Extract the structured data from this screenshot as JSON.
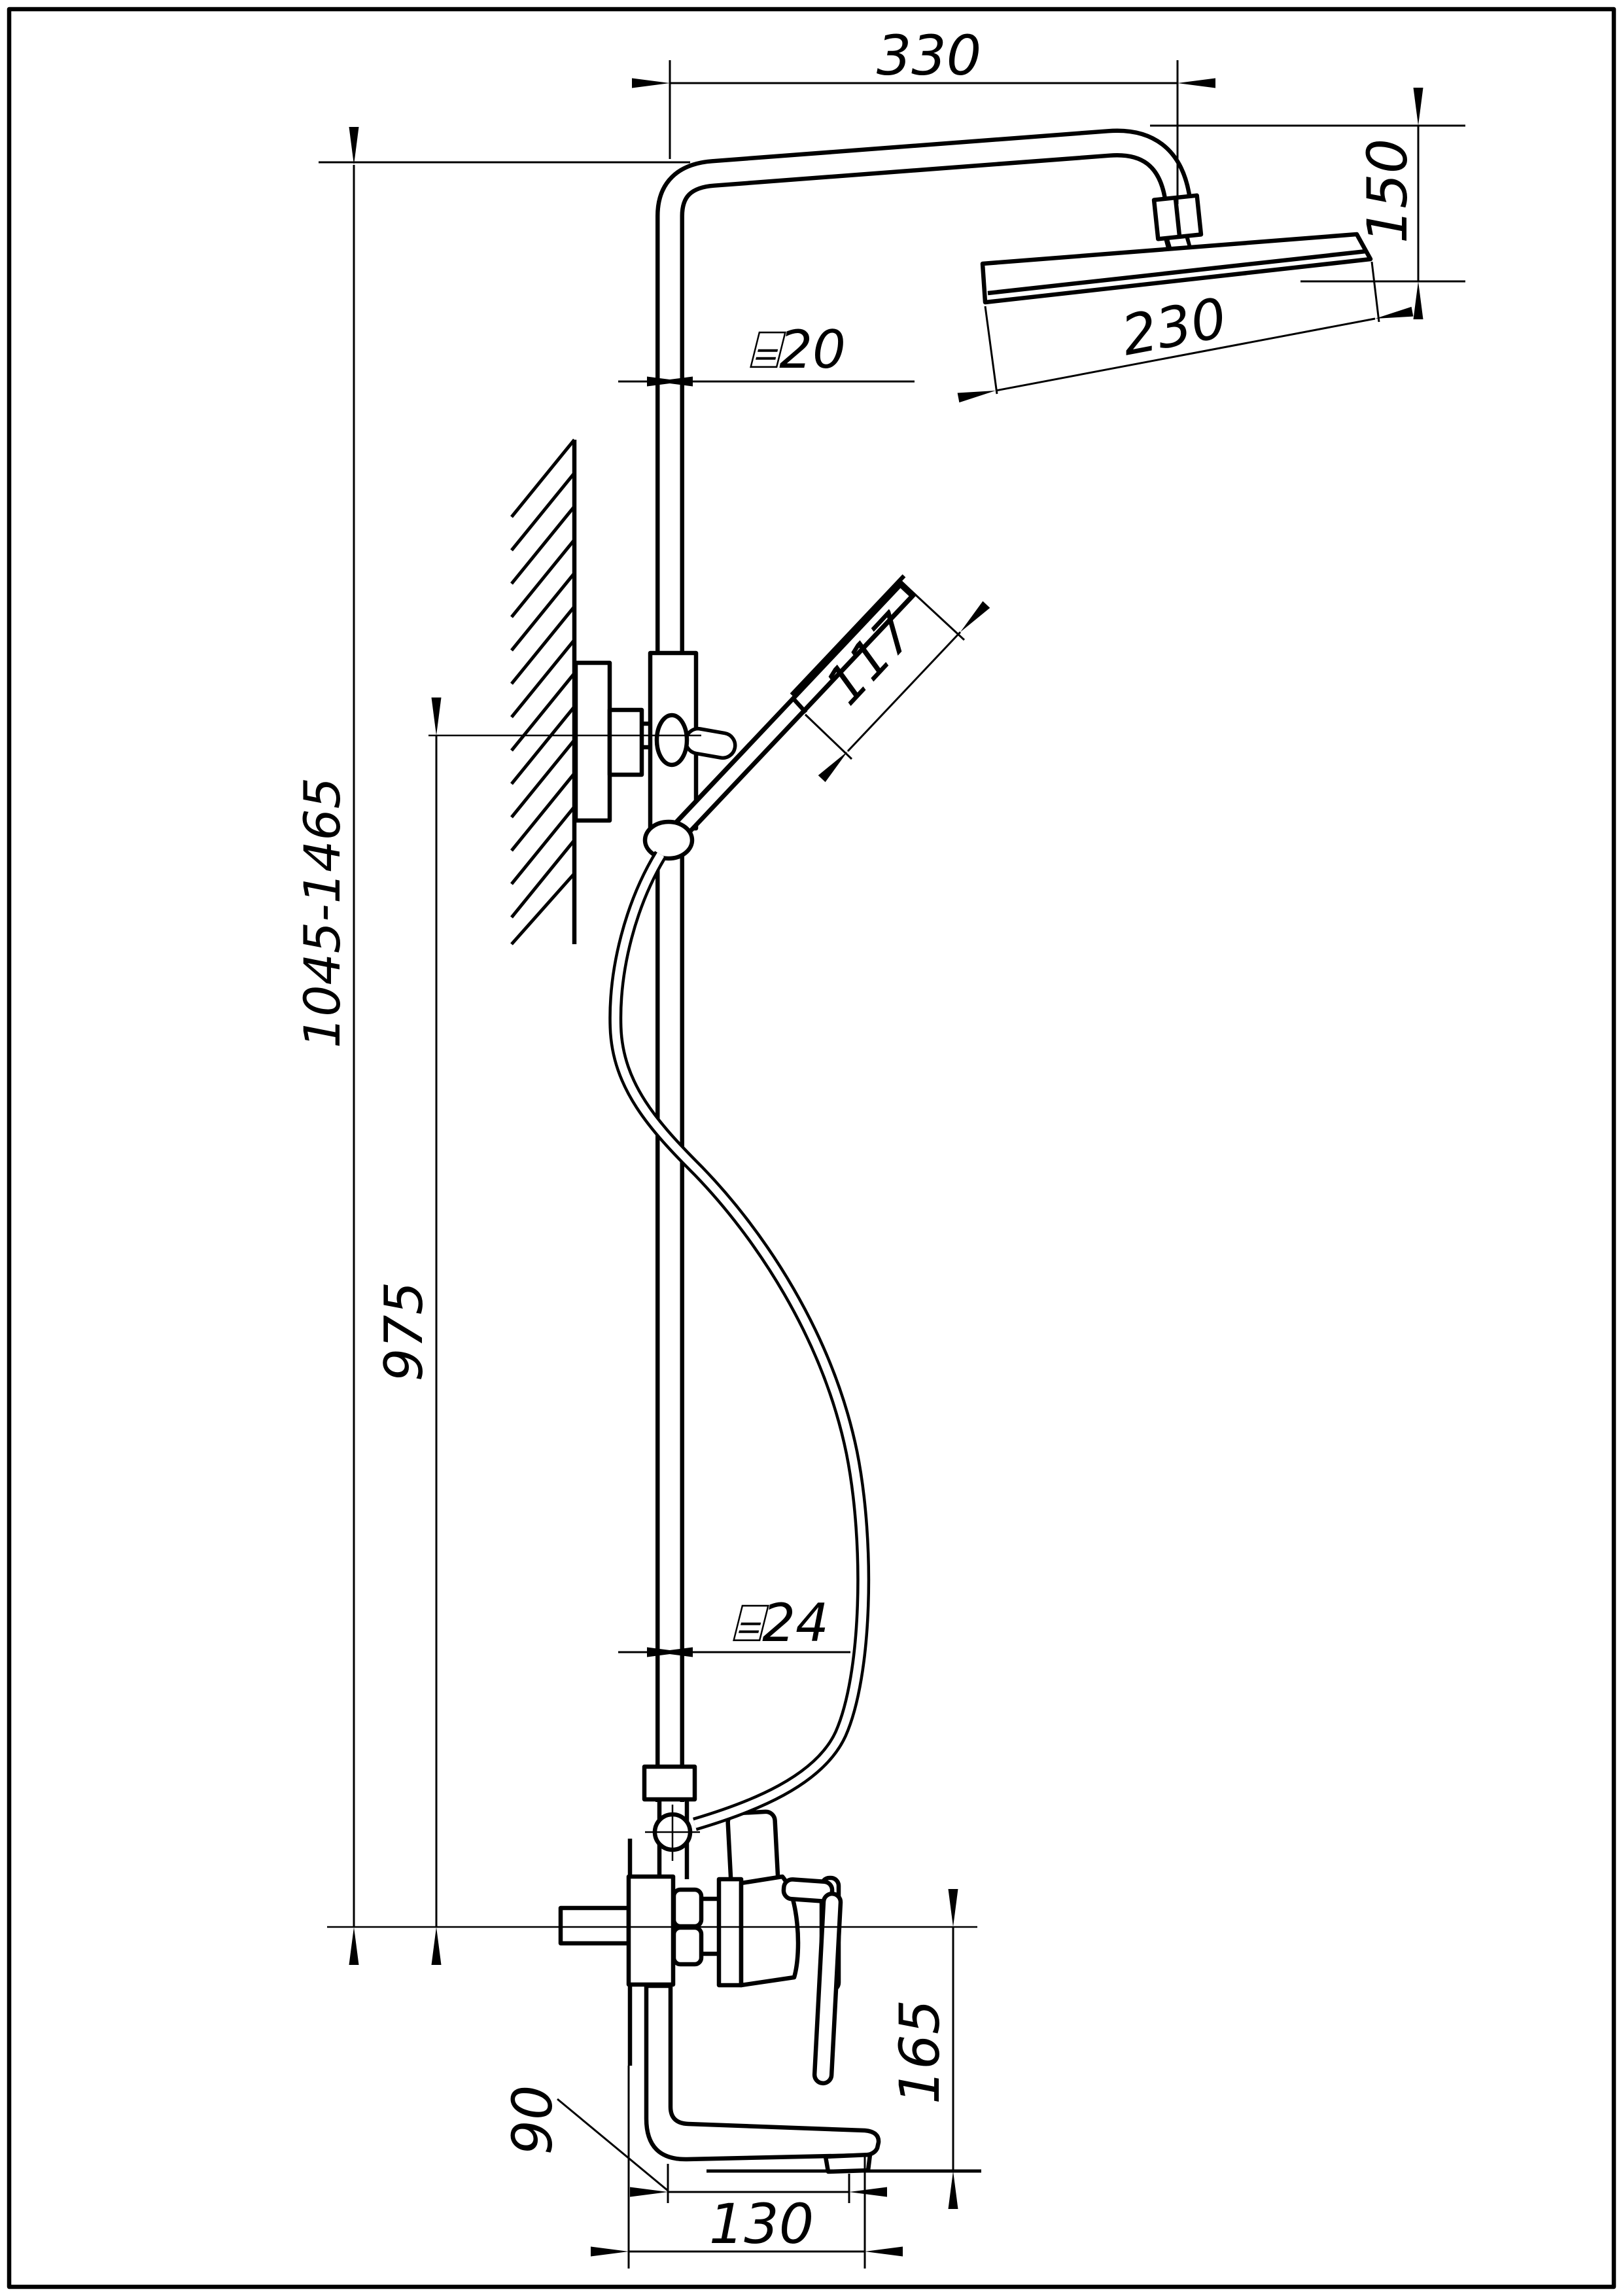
{
  "drawing": {
    "type": "technical-dimension-drawing",
    "subject": "Wall-mounted shower column with overhead shower, hand shower and bath mixer",
    "units": "mm",
    "line_color": "#000000",
    "background_color": "#ffffff",
    "dimensions": {
      "top_arm_offset": "330",
      "head_drop": "150",
      "head_length": "230",
      "riser_diameter": "⌸20",
      "hand_shower_head_length": "117",
      "column_height_range": "1045-1465",
      "riser_height": "975",
      "lower_riser_diameter": "⌸24",
      "spout_drop": "165",
      "spout_inner_reach": "90",
      "spout_reach": "130"
    }
  }
}
